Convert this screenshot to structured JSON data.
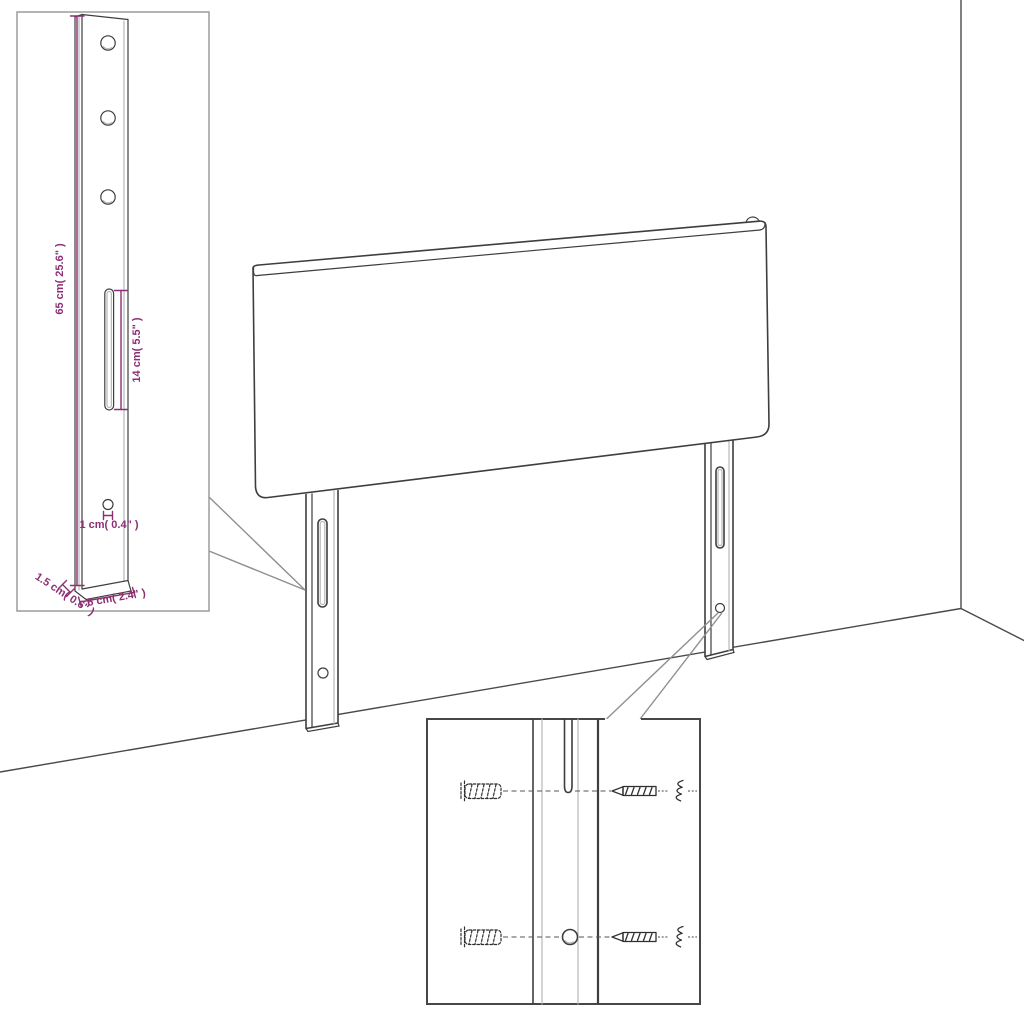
{
  "colors": {
    "background": "#ffffff",
    "line_dark": "#3e3e3e",
    "line_light": "#b8b8b8",
    "callout_gray": "#8f8f8f",
    "inset_border": "#9b9b9b",
    "detail_border": "#474747",
    "dimension_purple": "#8c2f74"
  },
  "insets": {
    "leg_dimensions": {
      "height_label": "65 cm( 25.6\" )",
      "slot_label": "14 cm( 5.5\" )",
      "hole_label": "1 cm( 0.4\" )",
      "thickness_label": "1.5 cm( 0.6\" )",
      "width_label": "6 cm( 2.4\" )"
    }
  }
}
